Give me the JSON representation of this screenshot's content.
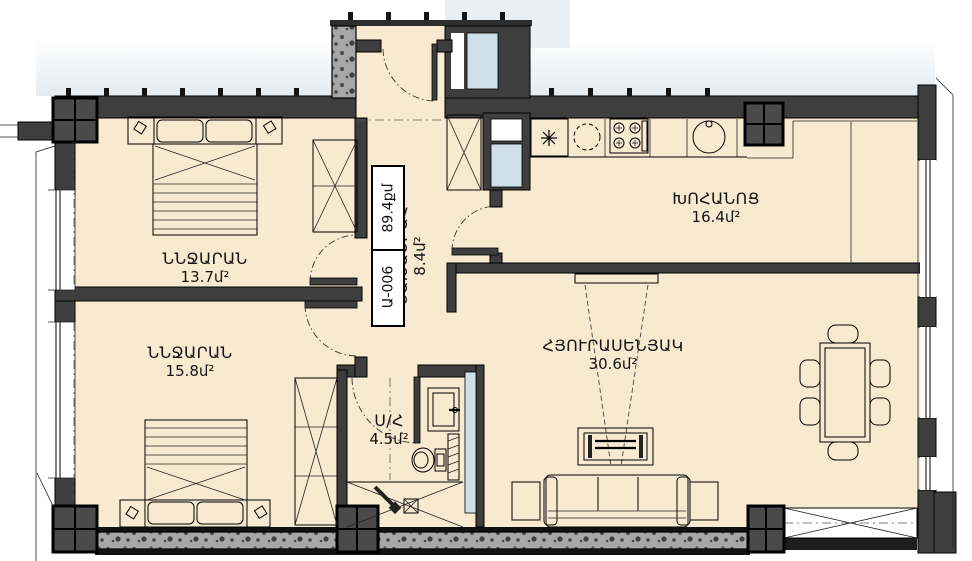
{
  "plan": {
    "unit_label": {
      "code": "Ա-006",
      "total_area": "89.4քմ"
    },
    "rooms": [
      {
        "id": "bedroom1",
        "name": "ՆՆՋԱՐԱՆ",
        "area": "13.7մ²"
      },
      {
        "id": "bedroom2",
        "name": "ՆՆՋԱՐԱՆ",
        "area": "15.8մ²"
      },
      {
        "id": "kitchen",
        "name": "ԽՈՀԱՆՈՑ",
        "area": "16.4մ²"
      },
      {
        "id": "living",
        "name": "ՀՅՈՒՐԱՍԵՆՅԱԿ",
        "area": "30.6մ²"
      },
      {
        "id": "hall",
        "name": "ՆԱԽԱՍՐԱՀ",
        "area": "8.4մ²"
      },
      {
        "id": "bathroom",
        "name": "Ս/Հ",
        "area": "4.5մ²"
      }
    ],
    "colors": {
      "wall": "#3e3e3e",
      "floor": "#f8ead0",
      "concrete": "#a7a7a7",
      "glass": "#cfe0e8",
      "outside": "#e6edf1"
    }
  }
}
